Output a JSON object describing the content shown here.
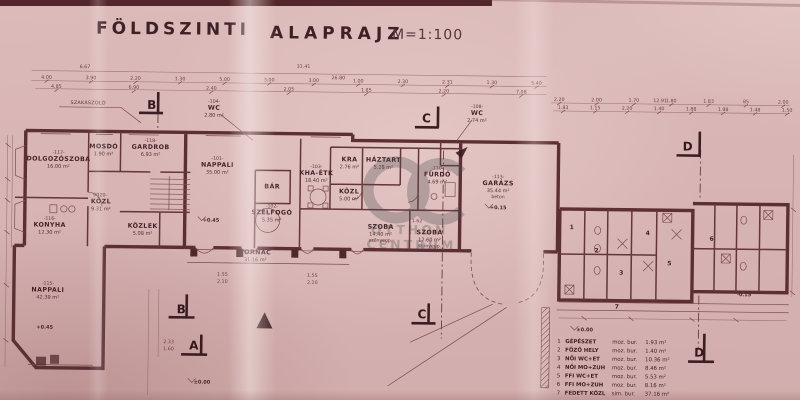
{
  "title": {
    "main": "FÖLDSZINTI",
    "main2": "ALAPRAJZ",
    "scale": "M=1:100"
  },
  "watermark": {
    "line1": "OTTHON",
    "line2": "CENTRUM"
  },
  "annotation": {
    "szakaszolo": "SZAKASZOLÓ"
  },
  "markers": {
    "a": "A",
    "b": "B",
    "c": "C",
    "d": "D"
  },
  "levels": {
    "zero": "±0.00",
    "plus045": "+0.45",
    "plus015": "+0.15",
    "minus015": "-0.15"
  },
  "wing_numbers": [
    "1",
    "2",
    "3",
    "4",
    "5",
    "6",
    "7"
  ],
  "rooms": {
    "dolgozoszoba": {
      "id": "-117-",
      "name": "DOLGOZÓSZOBA",
      "area": "16.00 m²"
    },
    "mosdo": {
      "id": "",
      "name": "MOSDÓ",
      "area": "1.90 m²"
    },
    "gardrob": {
      "id": "-118-",
      "name": "GARDROB",
      "area": "6.93 m²"
    },
    "kozl_left": {
      "id": "-120-",
      "name": "KÖZL",
      "area": "9.31 m²"
    },
    "konyha": {
      "id": "-116-",
      "name": "KONYHA",
      "area": "12.30 m²"
    },
    "kozlek": {
      "id": "",
      "name": "KÖZLEK",
      "area": "5.08 m²"
    },
    "nappali_left": {
      "id": "-115-",
      "name": "NAPPALI",
      "area": "42.39 m²"
    },
    "nappali_mid": {
      "id": "-101-",
      "name": "NAPPALI",
      "area": "35.00 m²"
    },
    "bar": {
      "id": "",
      "name": "BÁR",
      "area": ""
    },
    "szelfogo": {
      "id": "-102-",
      "name": "SZÉLFOGÓ",
      "area": "5.35 m²"
    },
    "kha_etk": {
      "id": "-103-",
      "name": "KHA-ÉTK",
      "area": "18.40 m²"
    },
    "wc_104": {
      "id": "-104-",
      "name": "WC",
      "area": "2.80 m²"
    },
    "kra": {
      "id": "",
      "name": "KRA",
      "area": "2.76 m²"
    },
    "haztart": {
      "id": "",
      "name": "HÁZTART",
      "area": "5.28 m²"
    },
    "kozl_mid": {
      "id": "",
      "name": "KÖZL",
      "area": "5.00 m²"
    },
    "furdo": {
      "id": "-110-",
      "name": "FÜRDŐ",
      "area": "4.69 m²"
    },
    "wc_108": {
      "id": "-108-",
      "name": "WC",
      "area": "2.74 m²"
    },
    "szoba_1": {
      "id": "",
      "name": "SZOBA",
      "area": "14.40 m²",
      "floor": "szőnyegp."
    },
    "szoba_2": {
      "id": "",
      "name": "SZOBA",
      "area": "12.60 m²",
      "floor": "szőnyegp."
    },
    "tornac": {
      "id": "",
      "name": "TORNÁC",
      "area": "31.16 m²"
    },
    "garazs": {
      "id": "-113-",
      "name": "GARÁZS",
      "area": "35.44 m²",
      "floor": "beton"
    }
  },
  "legend": {
    "rows": [
      {
        "num": "1",
        "name": "GÉPÉSZET",
        "floor": "moz. bur.",
        "area": "1.93 m²"
      },
      {
        "num": "2",
        "name": "FŐZŐ HELY",
        "floor": "moz. bur.",
        "area": "1.40 m²"
      },
      {
        "num": "3",
        "name": "NŐI WC+ET",
        "floor": "moz. bur.",
        "area": "10.36 m²"
      },
      {
        "num": "4",
        "name": "NŐI MO+ZUH",
        "floor": "moz. bur.",
        "area": "8.46 m²"
      },
      {
        "num": "5",
        "name": "FFI WC+ET",
        "floor": "moz. bur.",
        "area": "5.53 m²"
      },
      {
        "num": "6",
        "name": "FFI MO+ZUH",
        "floor": "moz. bur.",
        "area": "8.16 m²"
      },
      {
        "num": "7",
        "name": "FEDETT KÖZL",
        "floor": "sim. bur.",
        "area": "37.16 m²"
      }
    ]
  },
  "dims": {
    "overall": [
      "31.41",
      "26.80",
      "6.67",
      "12.91"
    ],
    "row_left_a": [
      "4.00",
      "3.90",
      "2.20",
      "1.30",
      "5.00",
      "3.00",
      "3.00",
      "1.00",
      "2.30",
      "2.31",
      "1.30",
      "5.40"
    ],
    "row_left_b": [
      "4.85",
      "6.90",
      "2.40",
      "2.05",
      "1.85",
      "2.20",
      "7.08"
    ],
    "row_right_a": [
      "2.20",
      "2.00",
      "1.70",
      "1.80",
      "1.83",
      "85",
      "2.00"
    ],
    "row_right_b": [
      "1.83",
      "1.15",
      "2.20",
      "1.40",
      "1.88",
      "1.98",
      "1.48",
      "1.50"
    ],
    "inner": [
      "1.55",
      "2.10",
      "90",
      "1.55",
      "2.10",
      "1.62"
    ],
    "a_marker": [
      "2.33",
      "1.60"
    ]
  }
}
